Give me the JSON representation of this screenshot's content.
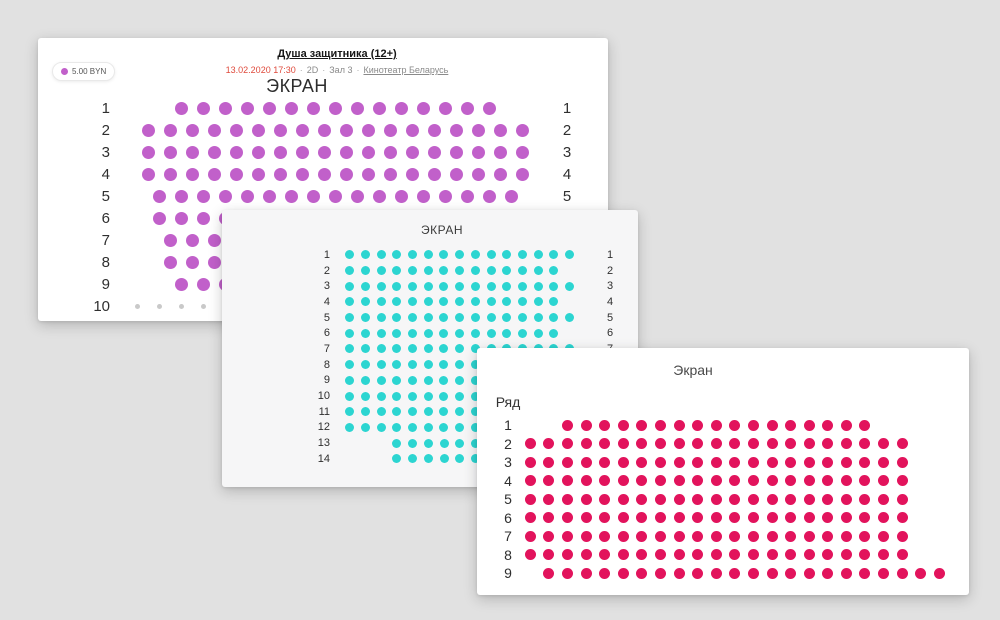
{
  "page": {
    "background": "#e1e1e1"
  },
  "cards": [
    {
      "id": "hall-a",
      "header": {
        "movie_title": "Душа защитника (12+)",
        "datetime": "13.02.2020 17:30",
        "separator": "·",
        "format": "2D",
        "hall": "Зал 3",
        "cinema": "Кинотеатр Беларусь"
      },
      "price_badge": {
        "label": "5.00 BYN"
      },
      "screen_label": "ЭКРАН",
      "seat_color": "#c160ca",
      "occupied_color": "#c9c9c9",
      "grid": {
        "pitch_x": 22,
        "pitch_y": 22,
        "dot": 13,
        "right_labels": true
      },
      "rows": [
        {
          "n": "1",
          "seats": 15,
          "offset": 1.5
        },
        {
          "n": "2",
          "seats": 18,
          "offset": 0
        },
        {
          "n": "3",
          "seats": 18,
          "offset": 0
        },
        {
          "n": "4",
          "seats": 18,
          "offset": 0
        },
        {
          "n": "5",
          "seats": 17,
          "offset": 0.5
        },
        {
          "n": "6",
          "seats": 17,
          "offset": 0.5
        },
        {
          "n": "7",
          "seats": 16,
          "offset": 1
        },
        {
          "n": "8",
          "seats": 16,
          "offset": 1
        },
        {
          "n": "9",
          "seats": 15,
          "offset": 1.5
        },
        {
          "n": "10",
          "seats": 17,
          "offset": -0.5,
          "state": "occupied"
        }
      ]
    },
    {
      "id": "hall-b",
      "screen_label": "ЭКРАН",
      "seat_color": "#2cd5d1",
      "grid": {
        "pitch_x": 15.7,
        "pitch_y": 15.7,
        "dot": 9,
        "right_labels": true
      },
      "rows": [
        {
          "n": "1",
          "seats": 15,
          "offset": 0
        },
        {
          "n": "2",
          "seats": 14,
          "offset": 0
        },
        {
          "n": "3",
          "seats": 15,
          "offset": 0
        },
        {
          "n": "4",
          "seats": 14,
          "offset": 0
        },
        {
          "n": "5",
          "seats": 15,
          "offset": 0
        },
        {
          "n": "6",
          "seats": 14,
          "offset": 0
        },
        {
          "n": "7",
          "seats": 15,
          "offset": 0
        },
        {
          "n": "8",
          "seats": 14,
          "offset": 0
        },
        {
          "n": "9",
          "seats": 15,
          "offset": 0
        },
        {
          "n": "10",
          "seats": 14,
          "offset": 0
        },
        {
          "n": "11",
          "seats": 15,
          "offset": 0
        },
        {
          "n": "12",
          "seats": 14,
          "offset": 0
        },
        {
          "n": "13",
          "seats": 9,
          "offset": 3
        },
        {
          "n": "14",
          "seats": 9,
          "offset": 3
        }
      ]
    },
    {
      "id": "hall-c",
      "screen_label": "Экран",
      "row_column_label": "Ряд",
      "seat_color": "#e2135c",
      "grid": {
        "pitch_x": 18.6,
        "pitch_y": 18.5,
        "dot": 11,
        "right_labels": false
      },
      "rows": [
        {
          "n": "1",
          "seats": 17,
          "offset": 2
        },
        {
          "n": "2",
          "seats": 21,
          "offset": 0
        },
        {
          "n": "3",
          "seats": 21,
          "offset": 0
        },
        {
          "n": "4",
          "seats": 21,
          "offset": 0
        },
        {
          "n": "5",
          "seats": 21,
          "offset": 0
        },
        {
          "n": "6",
          "seats": 21,
          "offset": 0
        },
        {
          "n": "7",
          "seats": 21,
          "offset": 0
        },
        {
          "n": "8",
          "seats": 21,
          "offset": 0
        },
        {
          "n": "9",
          "seats": 22,
          "offset": 1
        }
      ]
    }
  ]
}
